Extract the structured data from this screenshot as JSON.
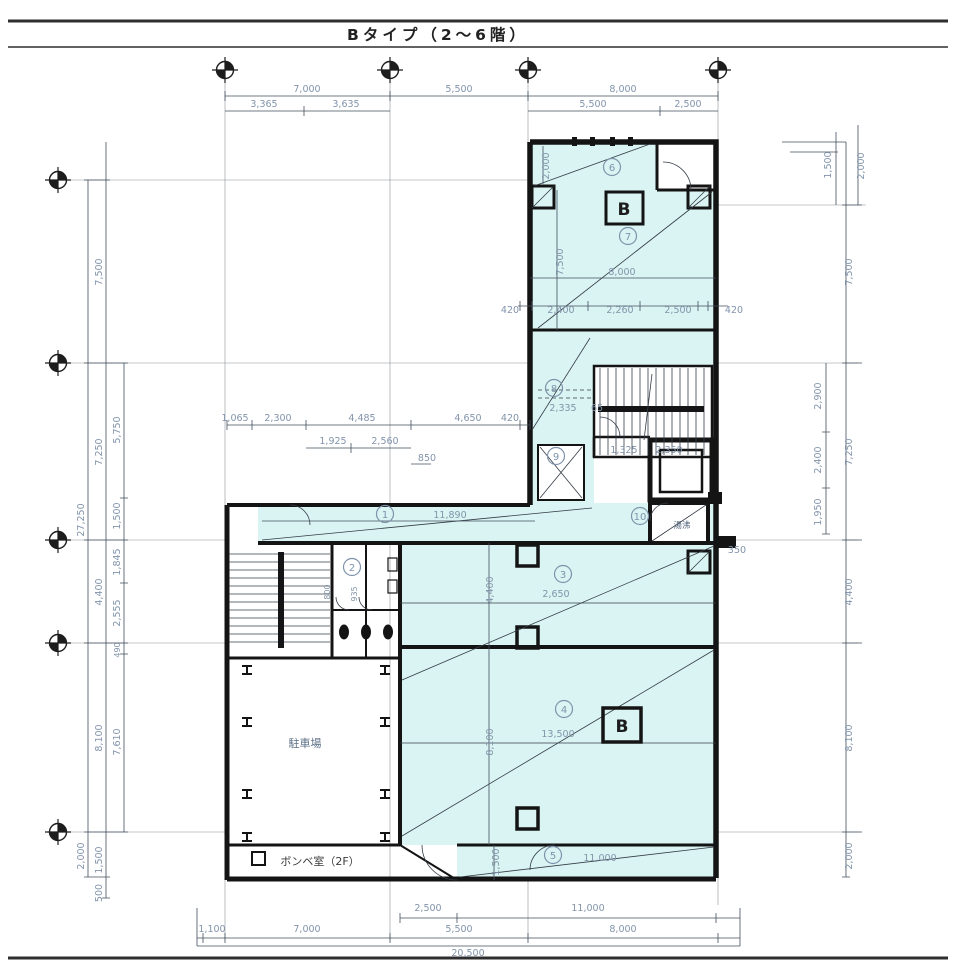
{
  "title": "Bタイプ（2〜6階）",
  "colors": {
    "room_fill": "#d9f4f2",
    "wall": "#141414",
    "dim_text": "#8294ab"
  },
  "rooms": {
    "n1": "1",
    "n2": "2",
    "n3": "3",
    "n4": "4",
    "n5": "5",
    "n6": "6",
    "n7": "7",
    "n8": "8",
    "n9": "9",
    "n10": "10",
    "b_upper": "B",
    "b_lower": "B",
    "parking": "駐車場",
    "cylinder": "ボンベ室（2F）",
    "kitchenette": "湯沸"
  },
  "dims": {
    "top": {
      "a": "7,000",
      "b": "5,500",
      "c": "8,000",
      "a1": "3,365",
      "a2": "3,635",
      "c1": "5,500",
      "c2": "2,500"
    },
    "left": {
      "total": "27,250",
      "b1": "7,500",
      "b2": "7,250",
      "b3": "4,400",
      "b4": "8,100",
      "b5": "2,000",
      "s1": "5,750",
      "s2": "1,500",
      "s3": "1,845",
      "s4": "2,555",
      "s5": "490",
      "s6": "7,610",
      "s7": "1,500",
      "s8": "500"
    },
    "right": {
      "t1": "1,500",
      "t2": "2,000",
      "b1": "7,500",
      "b2": "7,250",
      "b3": "4,400",
      "b4": "8,100",
      "b5": "2,000",
      "s1": "2,900",
      "s2": "2,400",
      "s3": "1,950"
    },
    "bottom": {
      "a": "2,500",
      "b": "11,000",
      "c": "1,100",
      "d": "7,000",
      "e": "5,500",
      "f": "8,000",
      "total": "20,500"
    },
    "inner": {
      "up_h": "2,000",
      "up_v": "7,500",
      "up_w": "8,000",
      "r1": "420",
      "r2": "2,400",
      "r3": "2,260",
      "r4": "2,500",
      "r5": "420",
      "m1": "2,335",
      "m2": "65",
      "m3": "1,325",
      "m4": "2,350",
      "m5": "350",
      "c1": "1,065",
      "c2": "2,300",
      "c3": "4,485",
      "c4": "4,650",
      "c5": "420",
      "c6": "1,925",
      "c7": "2,560",
      "c8": "850",
      "corridor": "11,890",
      "r3w": "2,650",
      "r3v": "4,400",
      "r4w": "13,500",
      "r4v": "8,100",
      "r5w": "11,000",
      "r5v": "1,500",
      "wc1": "800",
      "wc2": "935"
    }
  }
}
